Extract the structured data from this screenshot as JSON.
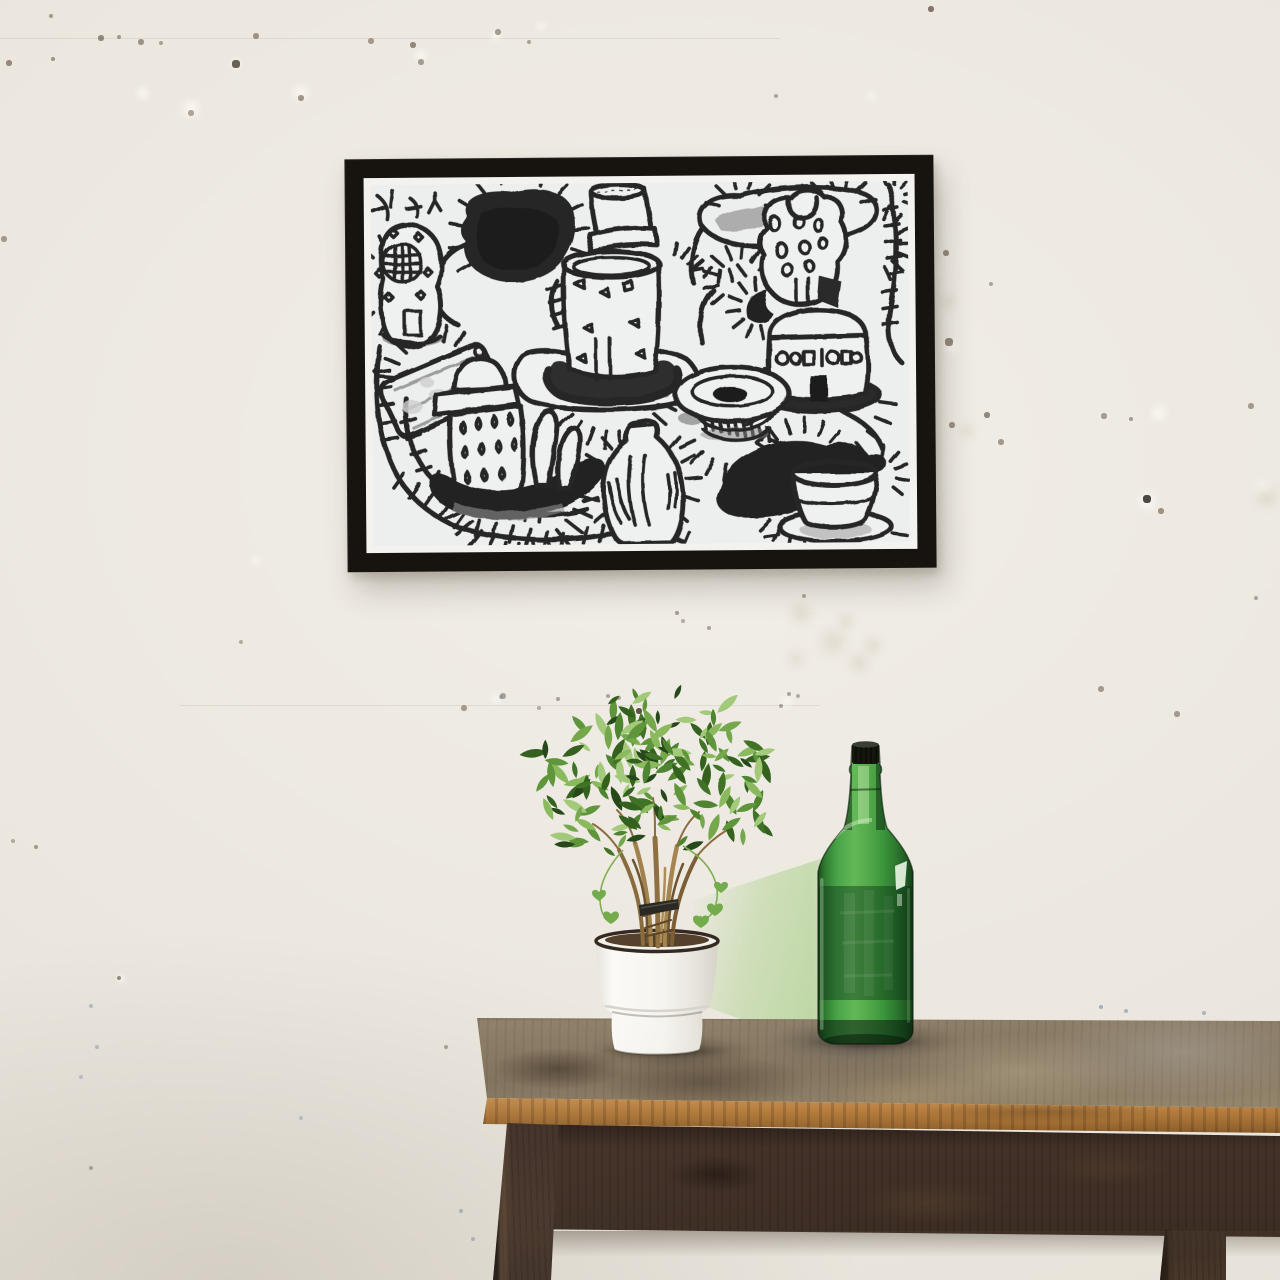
{
  "image": {
    "type": "photograph-mockup",
    "width": 1280,
    "height": 1280
  },
  "scene": {
    "wall": "white plaster wall with small nail holes, specks and repaired patches",
    "artwork": {
      "frame": "thin black wooden frame with white mat",
      "media": "black crayon outsider-art drawing on light grey paper",
      "subjects": [
        "domed kettle with teardrop holes on dark platter",
        "tall cylinder pot with striped cap on dark bowl",
        "round-window helmet vessel",
        "dark filled blob",
        "grey shaded blobs",
        "holey vessel with chimneys",
        "jar with glyph band and dark door on dark tray",
        "striped bowl with dark center",
        "jug with ladder bands",
        "pleated cup on saucer with dark swoosh",
        "wavy tick-marked paths and spiky sun outlines"
      ]
    },
    "furniture": "rustic weathered wooden side table with orange worn front edge, dark brown apron and legs",
    "tabletop_items": [
      {
        "name": "ficus plant",
        "detail": "bundled braided trunk tied with dark band, white enamel pot with dark rim"
      },
      {
        "name": "green glass bottle",
        "detail": "tall 2L bottle, black cap, green reflection cast on wall to its left"
      }
    ]
  },
  "colors": {
    "wall": "#edeae3",
    "frame": "#17130f",
    "paper": "#edefee",
    "ink": "#262626",
    "ink-gray": "#949494",
    "table-top": "#93846d",
    "table-edge": "#b17a3c",
    "table-edge-hi": "#c89152",
    "table-apron": "#453329",
    "table-leg": "#49372c",
    "pot": "#f6f4ef",
    "pot-rim": "#342a22",
    "soil": "#55412b",
    "trunk": "#9c7f4e",
    "trunk-dark": "#6d5430",
    "tie": "#2b2924",
    "vine": "#7fae54",
    "bottle-green": "#3f9a3e",
    "bottle-light": "#63b857",
    "bottle-dark": "#1c4a20",
    "bottle-band": "#14381a",
    "bottle-cap": "#15170f",
    "reflection": "#a0ce7a",
    "leaf-palette": [
      "#27481a",
      "#35611f",
      "#417326",
      "#4f8530",
      "#5f963c",
      "#74a84b",
      "#8bba5e",
      "#a3c97a"
    ]
  }
}
